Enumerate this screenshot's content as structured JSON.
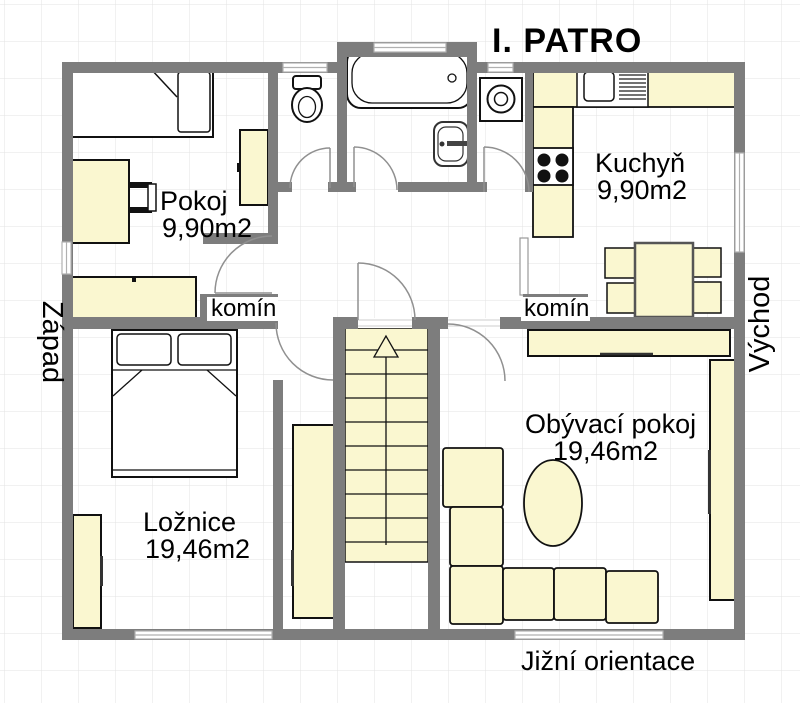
{
  "title": "I. PATRO",
  "floor_plan": {
    "rooms": {
      "pokoj": {
        "name": "Pokoj",
        "area": "9,90m2"
      },
      "kuchyn": {
        "name": "Kuchyň",
        "area": "9,90m2"
      },
      "loznice": {
        "name": "Ložnice",
        "area": "19,46m2"
      },
      "obyvaci_pokoj": {
        "name": "Obývací pokoj",
        "area": "19,46m2"
      }
    },
    "chimneys": {
      "left": "komín",
      "right": "komín"
    },
    "orientation": {
      "west": "Západ",
      "east": "Východ",
      "south": "Jižní orientace"
    }
  },
  "colors": {
    "wall": "#7d7d7d",
    "furniture_fill": "#faf7d0",
    "outline": "#111111",
    "door_arc": "#909090",
    "grid_line": "#e3e3e3",
    "background": "#ffffff"
  }
}
